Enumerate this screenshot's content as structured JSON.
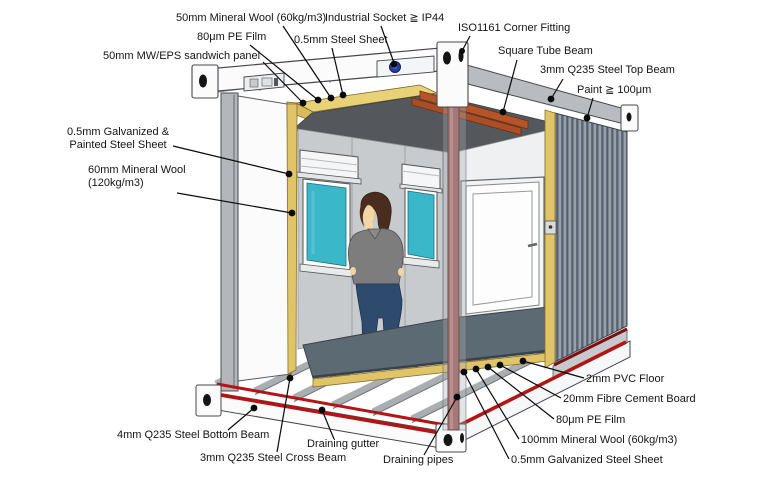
{
  "page": {
    "type": "technical-diagram",
    "subject": "container house structural cutaway",
    "background": "#ffffff"
  },
  "colors": {
    "insulation_yellow": "#dfc468",
    "ceiling_gray": "#54585c",
    "wall_gray": "#c8cbce",
    "corrugated_panel": "#97a0ab",
    "corrugated_rib": "#57626e",
    "square_tube_orange": "#b5542a",
    "steel_rail_red": "#b51414",
    "dark_red_rail": "#7c1010",
    "draining_pipe_maroon": "#a57878",
    "window_teal": "#3ab7c8",
    "socket_blue": "#24409e",
    "floor_slate": "#5c6a73",
    "frame_white": "#fbfbfc",
    "leader_black": "#0a0a0a"
  },
  "labels": {
    "mineral_wool_roof": "50mm Mineral Wool (60kg/m3)",
    "industrial_socket": "Industrial Socket ≧ IP44",
    "pe_film_roof": "80μm PE Film",
    "steel_sheet_roof": "0.5mm Steel Sheet",
    "sandwich_panel": "50mm MW/EPS sandwich panel",
    "corner_fitting": "ISO1161 Corner Fitting",
    "square_tube_beam": "Square Tube Beam",
    "steel_top_beam": "3mm Q235 Steel Top Beam",
    "paint": "Paint ≧ 100μm",
    "galvanized_painted_sheet": "0.5mm Galvanized & Painted Steel Sheet",
    "mineral_wool_wall": "60mm Mineral Wool (120kg/m3)",
    "steel_bottom_beam": "4mm Q235 Steel Bottom Beam",
    "draining_gutter": "Draining gutter",
    "steel_cross_beam": "3mm Q235 Steel Cross Beam",
    "draining_pipes": "Draining pipes",
    "pvc_floor": "2mm PVC Floor",
    "fibre_cement_board": "20mm Fibre Cement Board",
    "pe_film_floor": "80μm PE Film",
    "mineral_wool_floor": "100mm Mineral Wool (60kg/m3)",
    "galvanized_steel_sheet": "0.5mm Galvanized Steel Sheet"
  }
}
